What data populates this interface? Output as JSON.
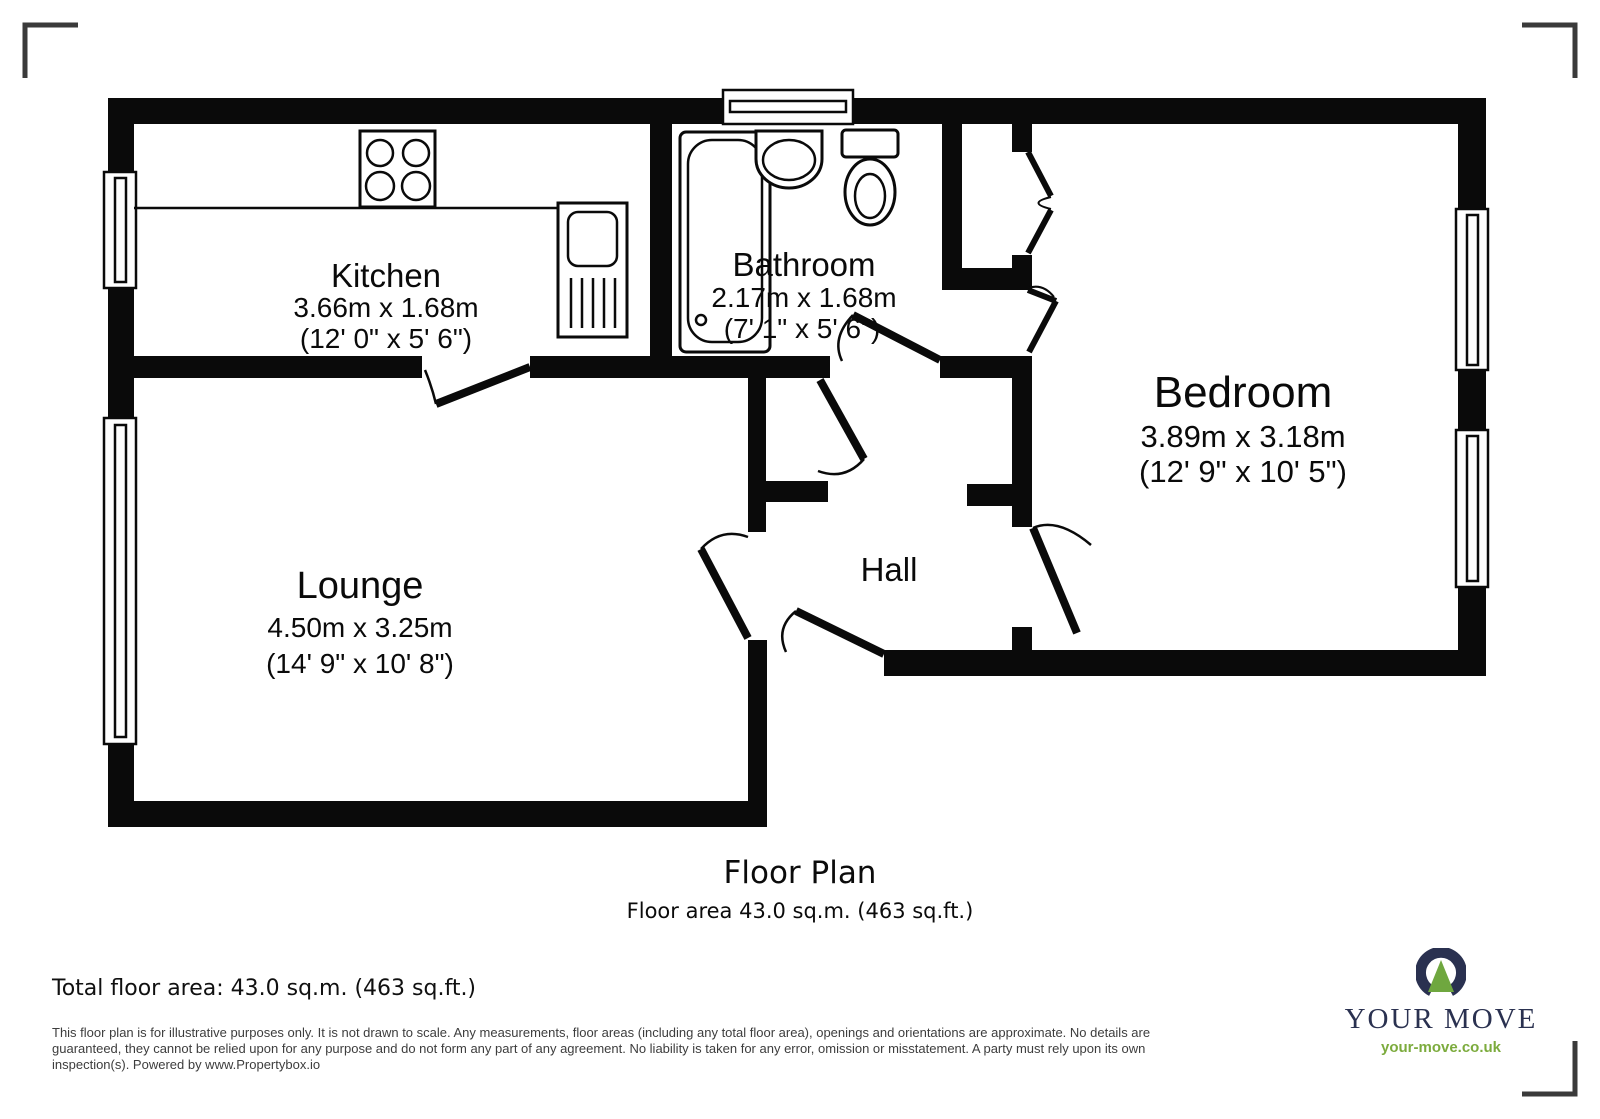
{
  "plan": {
    "rooms": {
      "kitchen": {
        "name": "Kitchen",
        "metric": "3.66m x 1.68m",
        "imperial": "(12' 0\" x 5' 6\")"
      },
      "bathroom": {
        "name": "Bathroom",
        "metric": "2.17m x 1.68m",
        "imperial": "(7' 1\" x 5' 6\")"
      },
      "bedroom": {
        "name": "Bedroom",
        "metric": "3.89m x 3.18m",
        "imperial": "(12' 9\" x 10' 5\")"
      },
      "lounge": {
        "name": "Lounge",
        "metric": "4.50m x 3.25m",
        "imperial": "(14' 9\" x 10' 8\")"
      },
      "hall": {
        "name": "Hall"
      }
    },
    "fixtures": [
      "hob-icon",
      "kitchen-sink-icon",
      "bathtub-icon",
      "wash-basin-icon",
      "toilet-icon",
      "window-icon",
      "door-swing-icon"
    ]
  },
  "footer": {
    "title": "Floor Plan",
    "area_line": "Floor area 43.0 sq.m. (463 sq.ft.)",
    "total_area": "Total floor area: 43.0 sq.m. (463 sq.ft.)",
    "disclaimer_lines": [
      "This floor plan is for illustrative purposes only. It is not drawn to scale. Any measurements, floor areas (including any total floor area), openings and orientations are approximate. No details are",
      "guaranteed, they cannot be relied upon for any purpose and do not form any part of any agreement. No liability is taken for any error, omission or misstatement. A party must rely upon its own",
      "inspection(s). Powered by www.Propertybox.io"
    ]
  },
  "logo": {
    "brand": "YOUR MOVE",
    "website": "your-move.co.uk"
  },
  "colors": {
    "wall": "#0a0a0a",
    "crop_mark": "#3a3a3a",
    "disclaimer_text": "#3d3d3d",
    "logo_navy": "#2a3150",
    "logo_green": "#6fa73f",
    "logo_url_green": "#7cab3d"
  }
}
